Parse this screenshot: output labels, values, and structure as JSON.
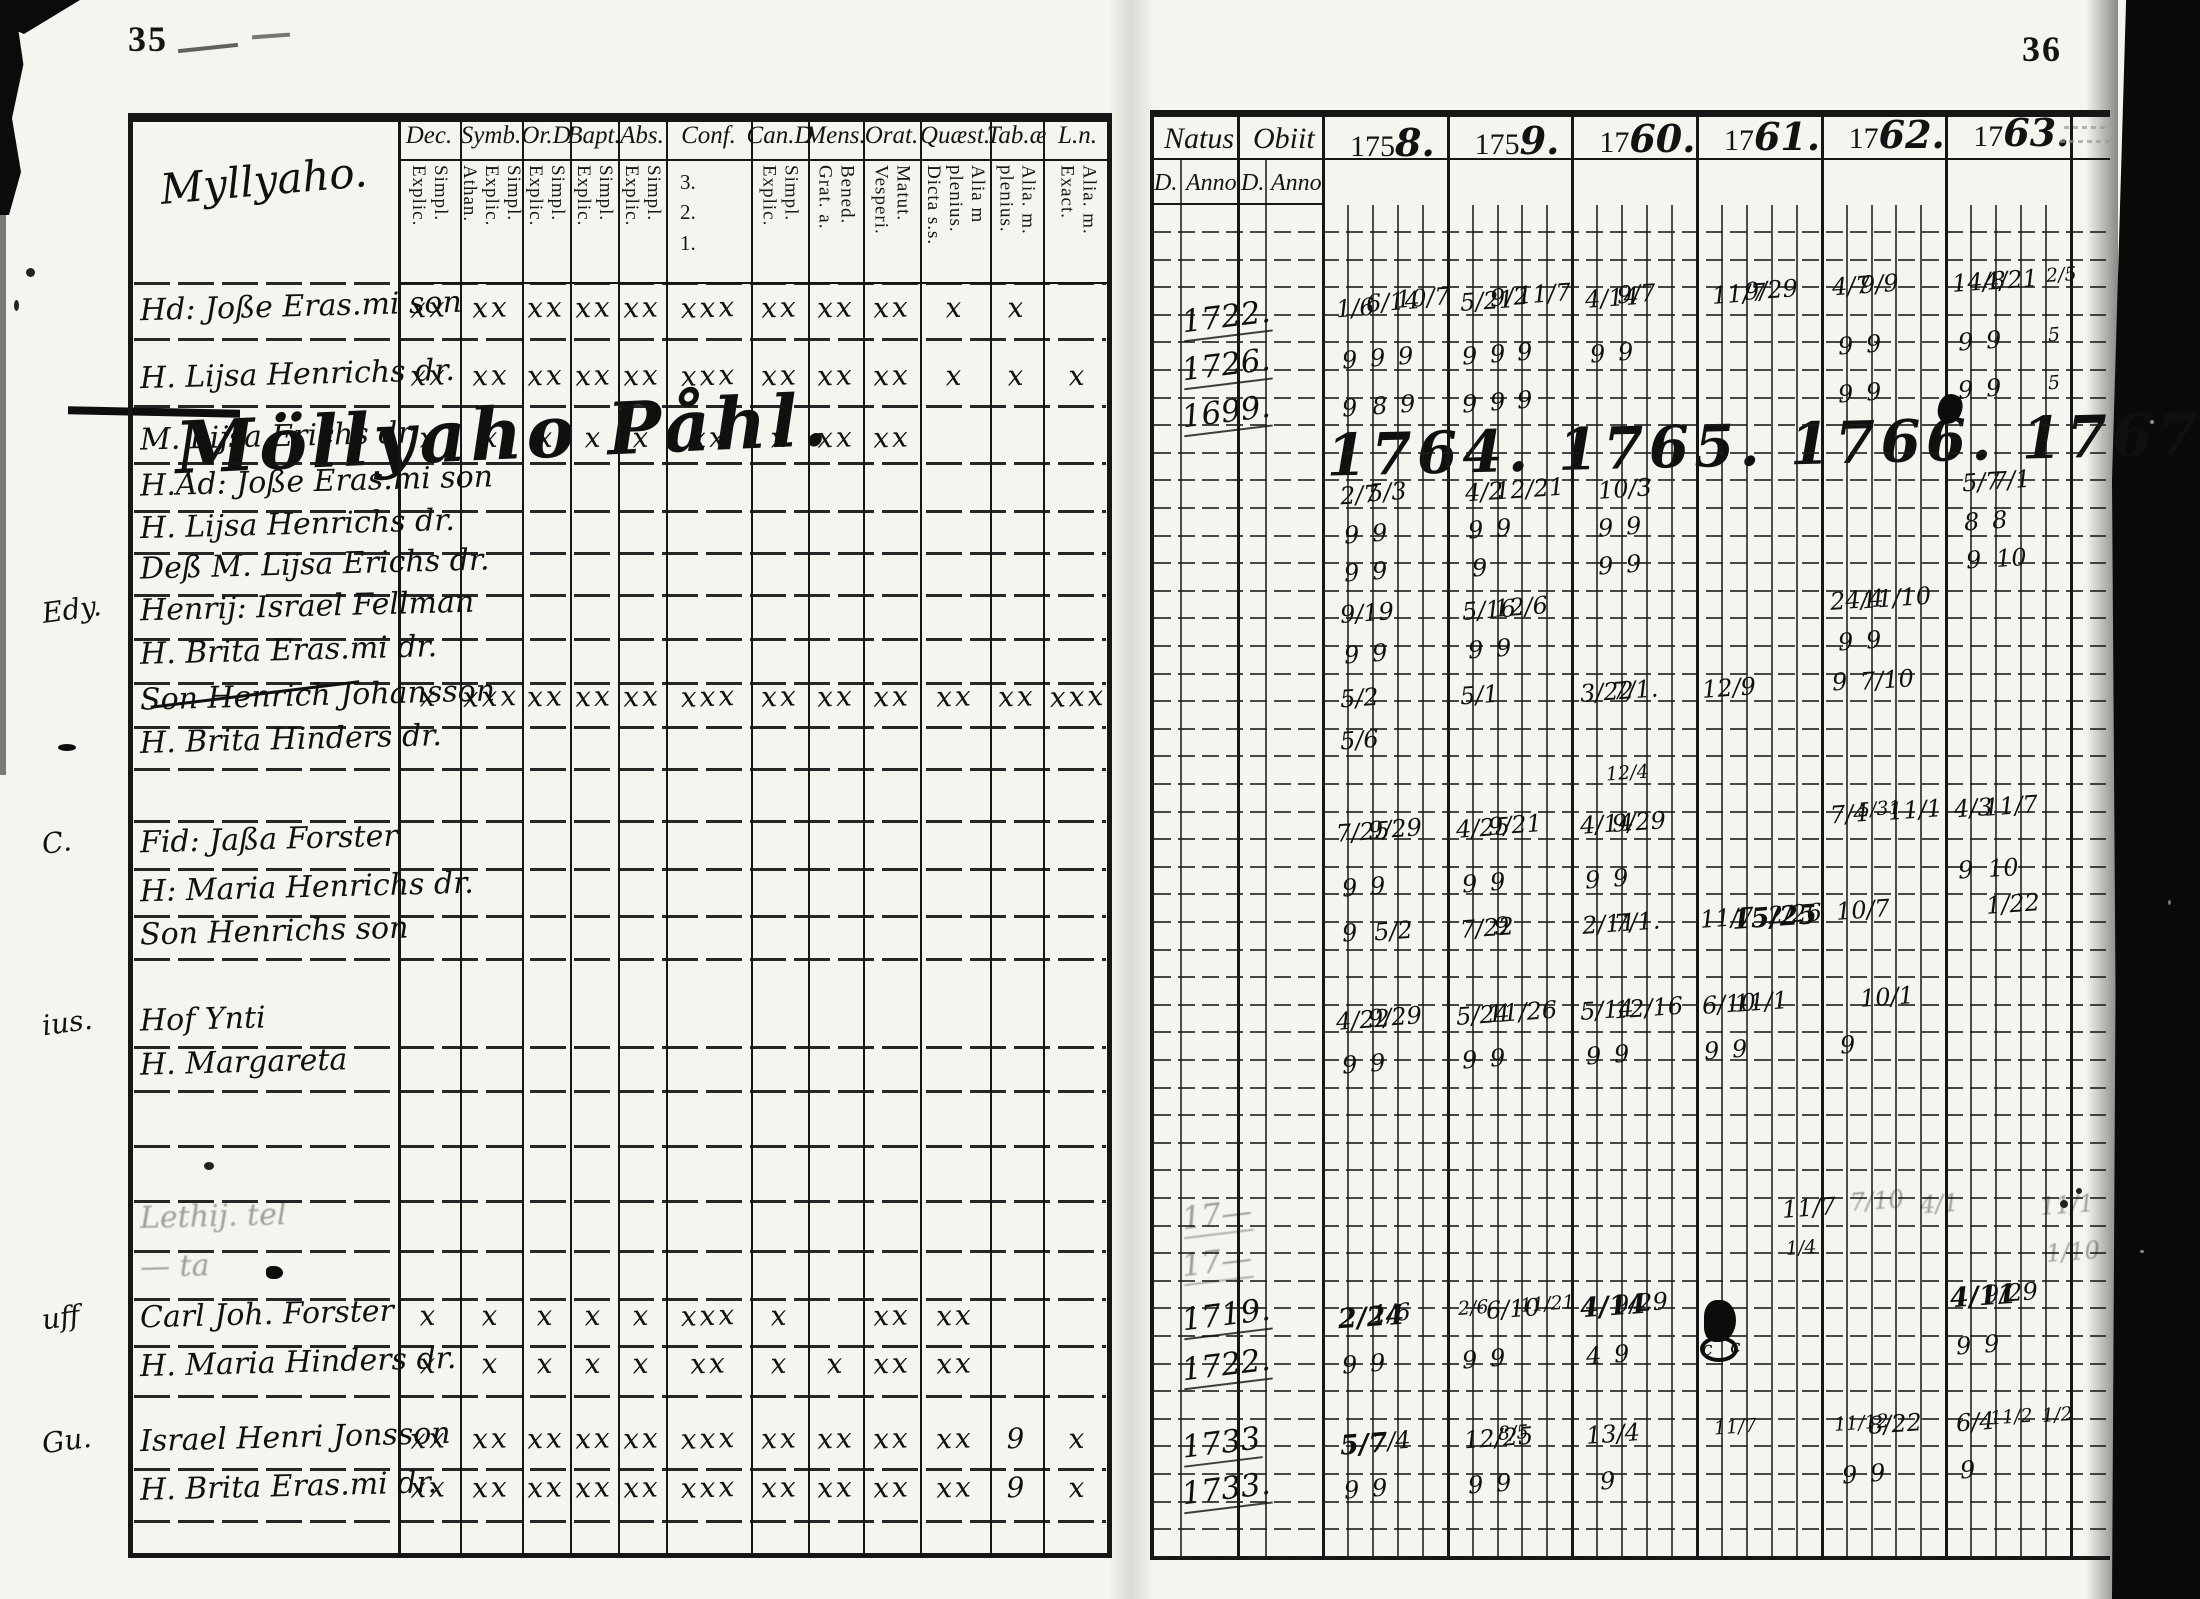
{
  "scan": {
    "left_page_number": "35",
    "right_page_number": "36"
  },
  "left_page": {
    "corner_script": "Myllyaho.",
    "section_heading": "Möllyaho Påhl.",
    "columns": [
      {
        "label": "Dec.",
        "subs": [
          "Explic.",
          "Simpl."
        ]
      },
      {
        "label": "Symb.",
        "subs": [
          "Athan.",
          "Explic.",
          "Simpl."
        ]
      },
      {
        "label": "Or.D",
        "subs": [
          "Explic.",
          "Simpl."
        ]
      },
      {
        "label": "Bapt.",
        "subs": [
          "Explic.",
          "Simpl."
        ]
      },
      {
        "label": "Abs.",
        "subs": [
          "Explic.",
          "Simpl."
        ]
      },
      {
        "label": "Conf.",
        "subs": [
          "3.",
          "2.",
          "1."
        ],
        "sub_style": "stacked"
      },
      {
        "label": "Can.D",
        "subs": [
          "Explic.",
          "Simpl."
        ]
      },
      {
        "label": "Mens.",
        "subs": [
          "Grat. a.",
          "Bened."
        ]
      },
      {
        "label": "Orat.",
        "subs": [
          "Vesperi.",
          "Matut."
        ]
      },
      {
        "label": "Quæst.",
        "subs": [
          "Dicta s.s.",
          "plenius.",
          "Alia m"
        ]
      },
      {
        "label": "Tab.æ",
        "subs": [
          "plenius.",
          "Alia. m."
        ]
      },
      {
        "label": "L.n.",
        "subs": [
          "Exact.",
          "Alia. m."
        ]
      }
    ],
    "rows": [
      {
        "y": 312,
        "name": "Hd: Joße Eras.mi son",
        "marks": [
          "xx",
          "xx",
          "xx",
          "xx",
          "xx",
          "xxx",
          "xx",
          "xx",
          "xx",
          "x",
          "x",
          ""
        ]
      },
      {
        "y": 380,
        "name": "H. Lijsa Henrichs dr.",
        "marks": [
          "xx",
          "xx",
          "xx",
          "xx",
          "xx",
          "xxx",
          "xx",
          "xx",
          "xx",
          "x",
          "x",
          "x"
        ]
      },
      {
        "y": 442,
        "name": "M. Lijsa Erichs dr.",
        "marks": [
          "x",
          "x",
          "x",
          "x",
          "x",
          "xx",
          "x",
          "xx",
          "xx",
          "",
          "",
          ""
        ]
      },
      {
        "y": 487,
        "name": "H.Ad: Joße Eras.mi son"
      },
      {
        "y": 530,
        "name": "H. Lijsa Henrichs dr."
      },
      {
        "y": 570,
        "name": "Deß M. Lijsa Erichs dr."
      },
      {
        "y": 612,
        "name": "Henrij: Israel Fellman",
        "margin": "Edy."
      },
      {
        "y": 656,
        "name": "H. Brita Eras.mi dr."
      },
      {
        "y": 701,
        "name": "Son Henrich Johansson",
        "struck": true,
        "marks": [
          "x",
          "xxx",
          "xx",
          "xx",
          "xx",
          "xxx",
          "xx",
          "xx",
          "xx",
          "xx",
          "xx",
          "xxx"
        ]
      },
      {
        "y": 745,
        "name": "H. Brita Hinders dr."
      },
      {
        "y": 845,
        "name": "Fid: Jaßa Forster",
        "margin": "C."
      },
      {
        "y": 893,
        "name": "H: Maria Henrichs dr."
      },
      {
        "y": 937,
        "name": "Son Henrichs son"
      },
      {
        "y": 1025,
        "name": "Hof Ynti",
        "margin": "ius."
      },
      {
        "y": 1068,
        "name": "H. Margareta"
      },
      {
        "y": 1222,
        "name": "Lethij. tel",
        "faint": true
      },
      {
        "y": 1272,
        "name": "— ta",
        "faint": true
      },
      {
        "y": 1320,
        "name": "Carl Joh. Forster",
        "margin": "uff",
        "marks": [
          "x",
          "x",
          "x",
          "x",
          "x",
          "xxx",
          "x",
          "",
          "xx",
          "xx",
          "",
          ""
        ]
      },
      {
        "y": 1368,
        "name": "H. Maria Hinders dr.",
        "marks": [
          "x",
          "x",
          "x",
          "x",
          "x",
          "xx",
          "x",
          "x",
          "xx",
          "xx",
          "",
          ""
        ]
      },
      {
        "y": 1443,
        "name": "Israel Henri Jonsson",
        "margin": "Gu.",
        "marks": [
          "xx",
          "xx",
          "xx",
          "xx",
          "xx",
          "xxx",
          "xx",
          "xx",
          "xx",
          "xx",
          "9",
          "x"
        ]
      },
      {
        "y": 1492,
        "name": "H. Brita Eras.mi dr.",
        "marks": [
          "xx",
          "xx",
          "xx",
          "xx",
          "xx",
          "xxx",
          "xx",
          "xx",
          "xx",
          "xx",
          "9",
          "x"
        ]
      }
    ]
  },
  "right_page": {
    "natus_label": "Natus",
    "obiit_label": "Obiit",
    "d_label": "D.",
    "anno_label": "Anno",
    "years": [
      {
        "printed": "175",
        "script": "8."
      },
      {
        "printed": "175",
        "script": "9."
      },
      {
        "printed": "17",
        "script": "60."
      },
      {
        "printed": "17",
        "script": "61."
      },
      {
        "printed": "17",
        "script": "62."
      },
      {
        "printed": "17",
        "script": "63."
      }
    ],
    "script_years": "1764. 1765. 1766. 1767. 1768. 1769.",
    "natus_anno": [
      {
        "y": 320,
        "t": "1722."
      },
      {
        "y": 368,
        "t": "1726."
      },
      {
        "y": 415,
        "t": "1699."
      },
      {
        "y": 1218,
        "t": "17—",
        "faint": true
      },
      {
        "y": 1265,
        "t": "17—",
        "faint": true
      },
      {
        "y": 1318,
        "t": "1719."
      },
      {
        "y": 1368,
        "t": "1722."
      },
      {
        "y": 1446,
        "t": "1733"
      },
      {
        "y": 1492,
        "t": "1733."
      }
    ],
    "entries": [
      {
        "x": 1336,
        "y": 310,
        "t": "1/6"
      },
      {
        "x": 1366,
        "y": 304,
        "t": "6/14"
      },
      {
        "x": 1396,
        "y": 300,
        "t": "10/7"
      },
      {
        "x": 1460,
        "y": 303,
        "t": "5/21"
      },
      {
        "x": 1490,
        "y": 299,
        "t": "9/2"
      },
      {
        "x": 1517,
        "y": 296,
        "t": "11/7"
      },
      {
        "x": 1585,
        "y": 300,
        "t": "4/14"
      },
      {
        "x": 1617,
        "y": 296,
        "t": "9/7"
      },
      {
        "x": 1712,
        "y": 296,
        "t": "11/7"
      },
      {
        "x": 1744,
        "y": 292,
        "t": "9/29"
      },
      {
        "x": 1832,
        "y": 288,
        "t": "4/7"
      },
      {
        "x": 1860,
        "y": 286,
        "t": "9/9"
      },
      {
        "x": 1952,
        "y": 284,
        "t": "14/8"
      },
      {
        "x": 1984,
        "y": 282,
        "t": "4/21"
      },
      {
        "x": 2046,
        "y": 280,
        "t": "2/5",
        "c": "sm"
      },
      {
        "x": 1342,
        "y": 362,
        "t": "9"
      },
      {
        "x": 1370,
        "y": 360,
        "t": "9"
      },
      {
        "x": 1398,
        "y": 358,
        "t": "9"
      },
      {
        "x": 1462,
        "y": 358,
        "t": "9"
      },
      {
        "x": 1490,
        "y": 356,
        "t": "9"
      },
      {
        "x": 1517,
        "y": 354,
        "t": "9"
      },
      {
        "x": 1590,
        "y": 356,
        "t": "9"
      },
      {
        "x": 1618,
        "y": 354,
        "t": "9"
      },
      {
        "x": 1838,
        "y": 348,
        "t": "9"
      },
      {
        "x": 1866,
        "y": 346,
        "t": "9"
      },
      {
        "x": 1958,
        "y": 344,
        "t": "9"
      },
      {
        "x": 1986,
        "y": 342,
        "t": "9"
      },
      {
        "x": 2048,
        "y": 340,
        "t": "5",
        "c": "sm"
      },
      {
        "x": 1342,
        "y": 410,
        "t": "9"
      },
      {
        "x": 1372,
        "y": 408,
        "t": "8"
      },
      {
        "x": 1400,
        "y": 406,
        "t": "9"
      },
      {
        "x": 1462,
        "y": 406,
        "t": "9"
      },
      {
        "x": 1490,
        "y": 404,
        "t": "9"
      },
      {
        "x": 1517,
        "y": 402,
        "t": "9"
      },
      {
        "x": 1838,
        "y": 396,
        "t": "9"
      },
      {
        "x": 1866,
        "y": 394,
        "t": "9"
      },
      {
        "x": 1958,
        "y": 392,
        "t": "9"
      },
      {
        "x": 1986,
        "y": 390,
        "t": "9"
      },
      {
        "x": 2048,
        "y": 388,
        "t": "5",
        "c": "sm"
      },
      {
        "x": 1340,
        "y": 497,
        "t": "2/7"
      },
      {
        "x": 1368,
        "y": 494,
        "t": "5/3"
      },
      {
        "x": 1465,
        "y": 494,
        "t": "4/2"
      },
      {
        "x": 1495,
        "y": 491,
        "t": "12/21"
      },
      {
        "x": 1598,
        "y": 491,
        "t": "10/3"
      },
      {
        "x": 1962,
        "y": 484,
        "t": "5/7"
      },
      {
        "x": 1992,
        "y": 482,
        "t": "7/1"
      },
      {
        "x": 1344,
        "y": 537,
        "t": "9"
      },
      {
        "x": 1372,
        "y": 535,
        "t": "9"
      },
      {
        "x": 1468,
        "y": 532,
        "t": "9"
      },
      {
        "x": 1496,
        "y": 530,
        "t": "9"
      },
      {
        "x": 1598,
        "y": 530,
        "t": "9"
      },
      {
        "x": 1626,
        "y": 528,
        "t": "9"
      },
      {
        "x": 1964,
        "y": 524,
        "t": "8"
      },
      {
        "x": 1992,
        "y": 522,
        "t": "8"
      },
      {
        "x": 1344,
        "y": 575,
        "t": "9"
      },
      {
        "x": 1372,
        "y": 573,
        "t": "9"
      },
      {
        "x": 1472,
        "y": 570,
        "t": "9"
      },
      {
        "x": 1598,
        "y": 568,
        "t": "9"
      },
      {
        "x": 1626,
        "y": 566,
        "t": "9"
      },
      {
        "x": 1966,
        "y": 562,
        "t": "9"
      },
      {
        "x": 1996,
        "y": 560,
        "t": "10"
      },
      {
        "x": 1340,
        "y": 615,
        "t": "9/19"
      },
      {
        "x": 1462,
        "y": 612,
        "t": "5/16"
      },
      {
        "x": 1494,
        "y": 609,
        "t": "12/6"
      },
      {
        "x": 1830,
        "y": 602,
        "t": "24/4"
      },
      {
        "x": 1862,
        "y": 600,
        "t": "11/10"
      },
      {
        "x": 1344,
        "y": 657,
        "t": "9"
      },
      {
        "x": 1372,
        "y": 655,
        "t": "9"
      },
      {
        "x": 1468,
        "y": 652,
        "t": "9"
      },
      {
        "x": 1496,
        "y": 650,
        "t": "9"
      },
      {
        "x": 1838,
        "y": 644,
        "t": "9"
      },
      {
        "x": 1866,
        "y": 642,
        "t": "9"
      },
      {
        "x": 1340,
        "y": 700,
        "t": "5/2"
      },
      {
        "x": 1460,
        "y": 697,
        "t": "5/1"
      },
      {
        "x": 1580,
        "y": 694,
        "t": "3/22"
      },
      {
        "x": 1612,
        "y": 692,
        "t": "7/1."
      },
      {
        "x": 1702,
        "y": 690,
        "t": "12/9"
      },
      {
        "x": 1832,
        "y": 684,
        "t": "9"
      },
      {
        "x": 1860,
        "y": 682,
        "t": "7/10"
      },
      {
        "x": 1340,
        "y": 742,
        "t": "5/6"
      },
      {
        "x": 1606,
        "y": 778,
        "t": "12/4",
        "c": "sm"
      },
      {
        "x": 1336,
        "y": 834,
        "t": "7/25"
      },
      {
        "x": 1368,
        "y": 831,
        "t": "9/29"
      },
      {
        "x": 1456,
        "y": 830,
        "t": "4/25"
      },
      {
        "x": 1488,
        "y": 827,
        "t": "9/21"
      },
      {
        "x": 1580,
        "y": 826,
        "t": "4/14"
      },
      {
        "x": 1612,
        "y": 824,
        "t": "9/29"
      },
      {
        "x": 1830,
        "y": 816,
        "t": "7/4"
      },
      {
        "x": 1858,
        "y": 814,
        "t": "5/31",
        "c": "sm"
      },
      {
        "x": 1888,
        "y": 812,
        "t": "11/1"
      },
      {
        "x": 1954,
        "y": 810,
        "t": "4/3"
      },
      {
        "x": 1984,
        "y": 808,
        "t": "11/7"
      },
      {
        "x": 1342,
        "y": 890,
        "t": "9"
      },
      {
        "x": 1370,
        "y": 888,
        "t": "9"
      },
      {
        "x": 1462,
        "y": 886,
        "t": "9"
      },
      {
        "x": 1490,
        "y": 884,
        "t": "9"
      },
      {
        "x": 1585,
        "y": 882,
        "t": "9"
      },
      {
        "x": 1613,
        "y": 880,
        "t": "9"
      },
      {
        "x": 1958,
        "y": 872,
        "t": "9"
      },
      {
        "x": 1988,
        "y": 870,
        "t": "10"
      },
      {
        "x": 1342,
        "y": 935,
        "t": "9"
      },
      {
        "x": 1374,
        "y": 933,
        "t": "5/2"
      },
      {
        "x": 1460,
        "y": 930,
        "t": "7/22"
      },
      {
        "x": 1494,
        "y": 928,
        "t": "9"
      },
      {
        "x": 1582,
        "y": 926,
        "t": "2/11"
      },
      {
        "x": 1614,
        "y": 924,
        "t": "7/1."
      },
      {
        "x": 1700,
        "y": 920,
        "t": "11/7"
      },
      {
        "x": 1732,
        "y": 918,
        "t": "15/25",
        "c": "bold"
      },
      {
        "x": 1768,
        "y": 916,
        "t": "2/26"
      },
      {
        "x": 1836,
        "y": 912,
        "t": "10/7"
      },
      {
        "x": 1986,
        "y": 906,
        "t": "1/22"
      },
      {
        "x": 1336,
        "y": 1022,
        "t": "4/22"
      },
      {
        "x": 1368,
        "y": 1019,
        "t": "9/29"
      },
      {
        "x": 1456,
        "y": 1017,
        "t": "5/24"
      },
      {
        "x": 1488,
        "y": 1014,
        "t": "11/26"
      },
      {
        "x": 1580,
        "y": 1012,
        "t": "5/14"
      },
      {
        "x": 1614,
        "y": 1010,
        "t": "12/16"
      },
      {
        "x": 1702,
        "y": 1006,
        "t": "6/10"
      },
      {
        "x": 1734,
        "y": 1004,
        "t": "11/1"
      },
      {
        "x": 1860,
        "y": 999,
        "t": "10/1"
      },
      {
        "x": 1342,
        "y": 1067,
        "t": "9"
      },
      {
        "x": 1370,
        "y": 1065,
        "t": "9"
      },
      {
        "x": 1462,
        "y": 1062,
        "t": "9"
      },
      {
        "x": 1490,
        "y": 1060,
        "t": "9"
      },
      {
        "x": 1586,
        "y": 1058,
        "t": "9"
      },
      {
        "x": 1614,
        "y": 1056,
        "t": "9"
      },
      {
        "x": 1704,
        "y": 1053,
        "t": "9"
      },
      {
        "x": 1732,
        "y": 1051,
        "t": "9"
      },
      {
        "x": 1840,
        "y": 1047,
        "t": "9"
      },
      {
        "x": 1782,
        "y": 1210,
        "t": "11/7"
      },
      {
        "x": 1786,
        "y": 1253,
        "t": "1/4",
        "c": "sm"
      },
      {
        "x": 1850,
        "y": 1203,
        "t": "7/10",
        "c": "faint"
      },
      {
        "x": 1920,
        "y": 1206,
        "t": "4/1",
        "c": "faint"
      },
      {
        "x": 2040,
        "y": 1207,
        "t": "11/1",
        "c": "faint"
      },
      {
        "x": 2046,
        "y": 1254,
        "t": "1/10",
        "c": "faint"
      },
      {
        "x": 1338,
        "y": 1318,
        "t": "2/24",
        "c": "bold"
      },
      {
        "x": 1372,
        "y": 1315,
        "t": "1/6"
      },
      {
        "x": 1458,
        "y": 1313,
        "t": "2/6",
        "c": "sm"
      },
      {
        "x": 1486,
        "y": 1311,
        "t": "6/10"
      },
      {
        "x": 1520,
        "y": 1309,
        "t": "11/21",
        "c": "sm"
      },
      {
        "x": 1580,
        "y": 1307,
        "t": "4/14",
        "c": "bold"
      },
      {
        "x": 1614,
        "y": 1305,
        "t": "9/29"
      },
      {
        "x": 1950,
        "y": 1297,
        "t": "4/11",
        "c": "bold"
      },
      {
        "x": 1984,
        "y": 1295,
        "t": "9/29"
      },
      {
        "x": 1342,
        "y": 1367,
        "t": "9"
      },
      {
        "x": 1370,
        "y": 1365,
        "t": "9"
      },
      {
        "x": 1462,
        "y": 1362,
        "t": "9"
      },
      {
        "x": 1490,
        "y": 1360,
        "t": "9"
      },
      {
        "x": 1586,
        "y": 1358,
        "t": "4"
      },
      {
        "x": 1614,
        "y": 1356,
        "t": "9"
      },
      {
        "x": 1702,
        "y": 1354,
        "t": "c",
        "c": "sm"
      },
      {
        "x": 1730,
        "y": 1352,
        "t": "c",
        "c": "sm"
      },
      {
        "x": 1956,
        "y": 1348,
        "t": "9"
      },
      {
        "x": 1984,
        "y": 1346,
        "t": "9"
      },
      {
        "x": 1340,
        "y": 1445,
        "t": "5/7",
        "c": "bold"
      },
      {
        "x": 1372,
        "y": 1443,
        "t": "7/4"
      },
      {
        "x": 1464,
        "y": 1440,
        "t": "12/25"
      },
      {
        "x": 1498,
        "y": 1438,
        "t": "8/5",
        "c": "sm"
      },
      {
        "x": 1586,
        "y": 1436,
        "t": "13/4"
      },
      {
        "x": 1714,
        "y": 1432,
        "t": "11/7",
        "c": "sm"
      },
      {
        "x": 1834,
        "y": 1428,
        "t": "11/12",
        "c": "sm"
      },
      {
        "x": 1868,
        "y": 1426,
        "t": "8/22"
      },
      {
        "x": 1956,
        "y": 1424,
        "t": "6/4"
      },
      {
        "x": 1990,
        "y": 1422,
        "t": "11/2",
        "c": "sm"
      },
      {
        "x": 2042,
        "y": 1420,
        "t": "1/2",
        "c": "sm"
      },
      {
        "x": 1344,
        "y": 1492,
        "t": "9"
      },
      {
        "x": 1372,
        "y": 1490,
        "t": "9"
      },
      {
        "x": 1468,
        "y": 1487,
        "t": "9"
      },
      {
        "x": 1496,
        "y": 1485,
        "t": "9"
      },
      {
        "x": 1600,
        "y": 1483,
        "t": "9"
      },
      {
        "x": 1842,
        "y": 1477,
        "t": "9"
      },
      {
        "x": 1870,
        "y": 1475,
        "t": "9"
      },
      {
        "x": 1960,
        "y": 1472,
        "t": "9"
      }
    ]
  }
}
